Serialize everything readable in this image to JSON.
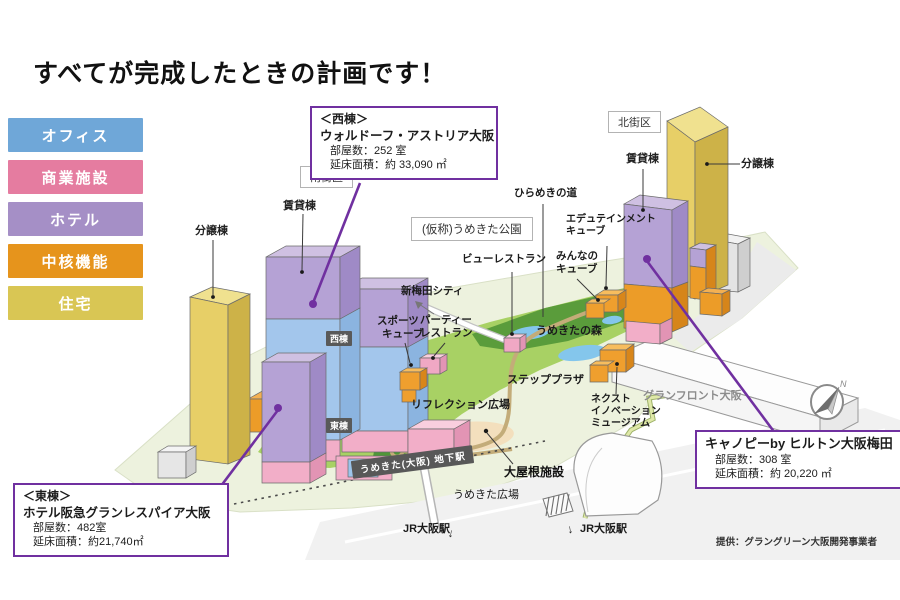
{
  "title": "すべてが完成したときの計画です！",
  "legend": {
    "items": [
      {
        "label": "オフィス",
        "color": "#6FA7D8"
      },
      {
        "label": "商業施設",
        "color": "#E57CA0"
      },
      {
        "label": "ホテル",
        "color": "#A58FC6"
      },
      {
        "label": "中核機能",
        "color": "#E6941C"
      },
      {
        "label": "住宅",
        "color": "#D9C654"
      }
    ]
  },
  "callouts": {
    "west": {
      "heading": "＜西棟＞",
      "name": "ウォルドーフ・アストリア大阪",
      "rooms": "部屋数：252 室",
      "area": "延床面積：約 33,090 ㎡"
    },
    "east": {
      "heading": "＜東棟＞",
      "name": "ホテル阪急グランレスパイア大阪",
      "rooms": "部屋数：482室",
      "area": "延床面積：約21,740㎡"
    },
    "canopy": {
      "name": "キャノピーby ヒルトン大阪梅田",
      "rooms": "部屋数：308 室",
      "area": "延床面積：約 20,220 ㎡"
    }
  },
  "districts": {
    "south": "南街区",
    "north": "北街区",
    "park": "(仮称)うめきた公園"
  },
  "buildings": {
    "south_rental": "賃貸棟",
    "south_condo": "分譲棟",
    "north_rental": "賃貸棟",
    "north_condo": "分譲棟",
    "west_badge": "西棟",
    "east_badge": "東棟"
  },
  "park_labels": {
    "hirameki": "ひらめきの道",
    "edutainment": [
      "エデュテインメント",
      "キューブ"
    ],
    "minna": [
      "みんなの",
      "キューブ"
    ],
    "view_restaurant": "ビューレストラン",
    "shin_umeda": "新梅田シティ",
    "sports": [
      "スポーツ",
      "キューブ"
    ],
    "party": [
      "パーティー",
      "レストラン"
    ],
    "forest": "うめきたの森",
    "step_plaza": "ステッププラザ",
    "reflection": "リフレクション広場",
    "next_museum": [
      "ネクスト",
      "イノベーション",
      "ミュージアム"
    ]
  },
  "area_labels": {
    "grand_front": "グランフロント大阪",
    "roof_facility": "大屋根施設",
    "underground_station": "うめきた(大阪) 地下駅",
    "plaza": "うめきた広場",
    "jr_left": "JR大阪駅",
    "jr_right": "JR大阪駅"
  },
  "credit": "提供：グラングリーン大阪開発事業者",
  "compass": {
    "n": "N"
  },
  "arrows": {
    "down": "↓"
  },
  "colors": {
    "accent_purple": "#7030A0",
    "office_blue": "#A3C6EC",
    "commerce_pink": "#F2AEC8",
    "hotel_purple": "#B5A2D5",
    "core_orange": "#EC9C28",
    "residence_yellow": "#E7CF67",
    "park_green": "#A8D164"
  }
}
